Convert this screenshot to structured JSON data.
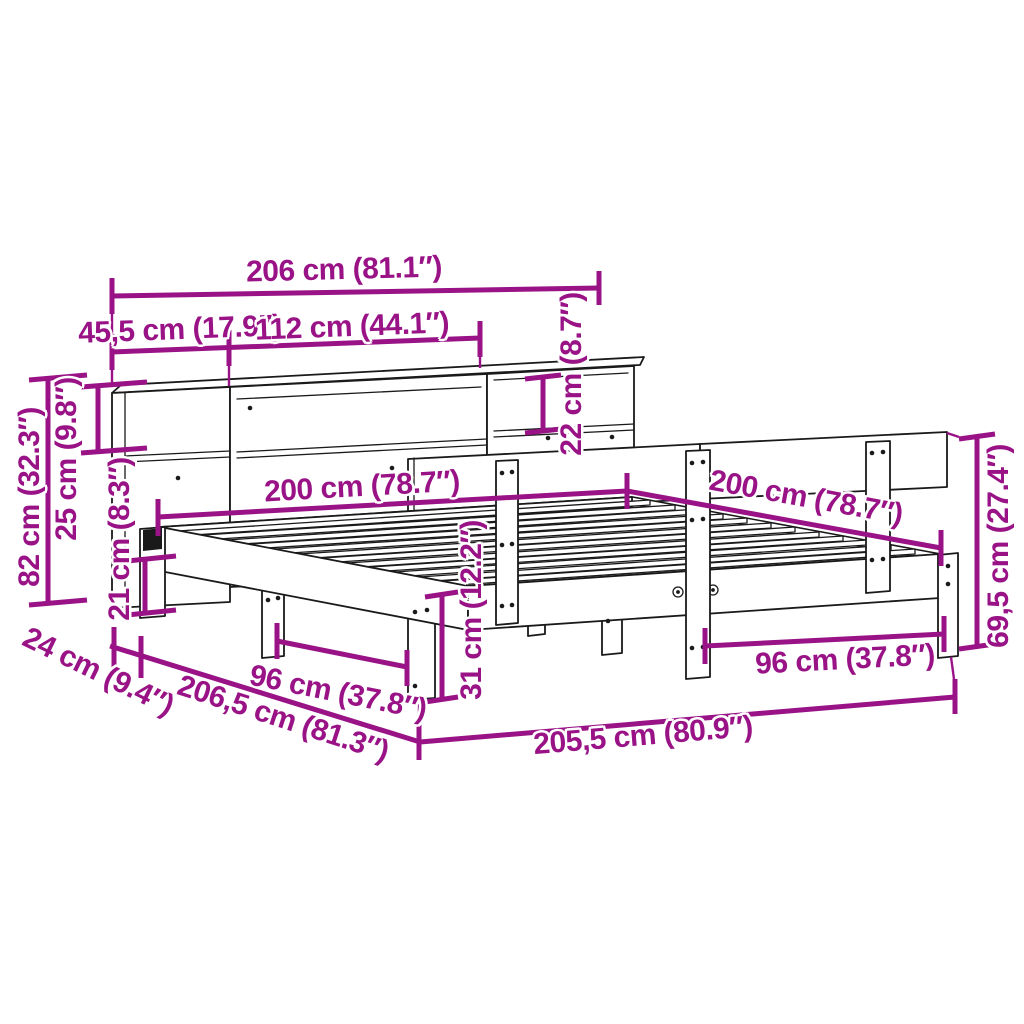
{
  "figure": {
    "type": "product-dimension-diagram",
    "subject": "bed frame with bookcase headboard and slatted base"
  },
  "colors": {
    "dimension": "#991387",
    "line": "#1a1a1a",
    "background": "#ffffff"
  },
  "dimensions": {
    "bookcase_width": "206 cm (81.1″)",
    "bookcase_left_section_width": "45,5 cm (17.9″)",
    "bookcase_middle_section_width": "112 cm (44.1″)",
    "shelf_opening_height": "22 cm (8.7″)",
    "bookcase_height": "82 cm (32.3″)",
    "upper_shelf_height": "25 cm (9.8″)",
    "under_frame_clearance": "21 cm (8.3″)",
    "bed_width": "200 cm (78.7″)",
    "bed_length": "200 cm (78.7″)",
    "rail_height": "69,5 cm (27.4″)",
    "frame_height": "31 cm (12.2″)",
    "leg_spacing_left": "96 cm (37.8″)",
    "leg_spacing_right": "96 cm (37.8″)",
    "frame_offset_depth": "24 cm (9.4″)",
    "total_depth": "206,5 cm (81.3″)",
    "total_width": "205,5 cm (80.9″)"
  }
}
